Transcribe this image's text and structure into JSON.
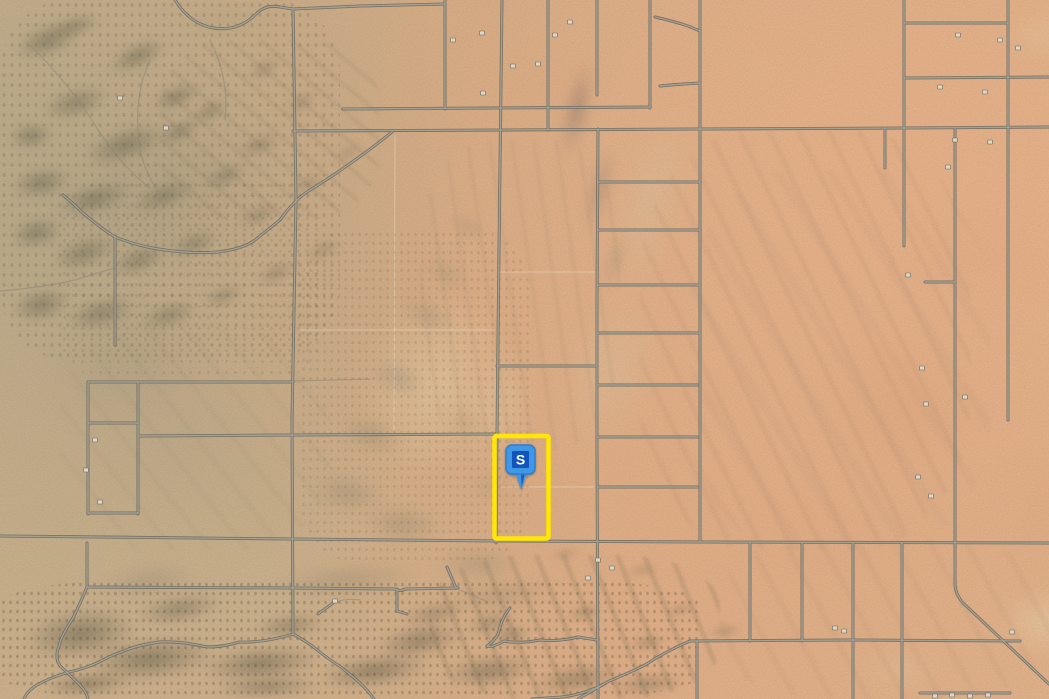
{
  "map": {
    "type": "satellite-parcel-map",
    "marker": {
      "label": "S",
      "x": 504,
      "y": 443,
      "width": 34,
      "height": 52,
      "head_fill": "#3f97e6",
      "head_stroke": "#2f7fd0",
      "inner_fill": "#1154bd",
      "tail_shade": "#1c5cb8",
      "label_color": "#ffffff"
    },
    "parcel_highlight": {
      "x": 494.5,
      "y": 436,
      "width": 54,
      "height": 102.5,
      "color": "#ffe604",
      "stroke_width": 4.5
    },
    "road_colors": {
      "casing": "#67655c",
      "fill": "#a6a396"
    },
    "roads": {
      "main": [
        "M175,0 Q190,24 213,28 Q238,32 256,14 Q266,4 280,7 L293,9 L360,6 L445,4",
        "M293,9 L296,200 L292,420 L293,634",
        "M502,0 L499,250 L497,434 L496,543",
        "M445,0 L445,109",
        "M548,0 L548,130",
        "M597,0 L597,95",
        "M598,129 L597,300 L597,450 L598,699",
        "M650,0 L650,108",
        "M700,0 L700,542",
        "M904,0 L904,246",
        "M955,129 L955,583 Q955,594 963,603 L1049,684",
        "M1008,0 L1008,420",
        "M885,129 L885,168",
        "M88,382 L88,514",
        "M138,382 L138,514",
        "M115,237 L115,345",
        "M293,131 L700,129 L905,128 L1049,127",
        "M343,109 L650,107",
        "M904,23 L1008,23",
        "M904,78 L1049,77",
        "M925,282 L955,282",
        "M598,182 L700,182",
        "M598,230 L700,230",
        "M598,285 L700,285",
        "M598,333 L700,333",
        "M597,385 L698,385",
        "M597,437 L698,437",
        "M597,487 L698,487",
        "M497,366 L597,366",
        "M88,382 L293,382",
        "M138,436 L293,435 L497,434",
        "M88,423 L138,423",
        "M88,513 L138,513",
        "M0,536 L293,539 L497,541 L700,542 L1049,543",
        "M88,587 L293,588 L395,589 Q401,592 405,589 L458,588",
        "M447,567 L456,588",
        "M318,614 L333,603",
        "M397,589 L397,611 L407,614",
        "M690,641 L853,640 L1020,641",
        "M690,641 Q668,650 645,665 Q622,676 607,682 Q596,689 583,696 L578,699",
        "M604,684 Q585,694 562,697 L532,699",
        "M597,640 L578,637 Q558,642 540,640 Q520,644 504,641 Q492,648 487,646 Q497,639 499,631 Q502,617 510,608",
        "M750,543 L750,641",
        "M802,543 L802,641",
        "M853,543 L853,699",
        "M902,543 L902,699",
        "M697,641 L697,699",
        "M87,543 L87,587 Q79,606 73,618 Q61,636 59,646 Q54,659 61,667 Q70,675 80,685 Q87,693 88,699",
        "M293,634 Q264,643 240,642 Q214,649 202,646 Q179,641 159,642 Q139,645 126,650 Q108,657 99,662 Q84,669 69,672 Q49,678 37,685 Q27,691 24,699",
        "M293,634 Q306,641 316,649 Q331,661 341,667 Q356,679 362,685 Q370,693 374,699",
        "M655,17 Q673,21 688,26 L700,31",
        "M660,86 Q680,84 700,83",
        "M920,693 L1010,693",
        "M63,195 Q75,205 83,213 Q98,226 115,237",
        "M115,237 Q140,247 165,250 Q195,254 218,252 Q243,249 255,240 Q270,228 280,220",
        "M392,132 Q375,146 355,160 Q330,178 310,190 Q295,199 280,220"
      ],
      "faint": [
        "M293,381 L370,379",
        "M0,291 Q45,287 75,280 Q100,272 115,268",
        "M30,45 Q70,85 95,125 Q120,165 150,188",
        "M150,60 Q132,100 140,150 Q146,175 160,195",
        "M210,40 Q230,80 225,120",
        "M455,588 Q475,596 488,602",
        "M333,603 Q345,598 360,600"
      ],
      "survey_lines": [
        "M395,135 L394,430",
        "M300,330 L495,330",
        "M500,272 L595,272",
        "M500,487 L595,487"
      ]
    },
    "buildings": [
      [
        482,
        33
      ],
      [
        555,
        35
      ],
      [
        570,
        22
      ],
      [
        513,
        66
      ],
      [
        538,
        64
      ],
      [
        483,
        93
      ],
      [
        453,
        40
      ],
      [
        958,
        35
      ],
      [
        1000,
        40
      ],
      [
        1018,
        48
      ],
      [
        940,
        87
      ],
      [
        985,
        92
      ],
      [
        955,
        140
      ],
      [
        990,
        142
      ],
      [
        948,
        167
      ],
      [
        908,
        275
      ],
      [
        922,
        368
      ],
      [
        965,
        397
      ],
      [
        926,
        404
      ],
      [
        918,
        477
      ],
      [
        931,
        496
      ],
      [
        835,
        628
      ],
      [
        844,
        631
      ],
      [
        1012,
        632
      ],
      [
        598,
        560
      ],
      [
        612,
        568
      ],
      [
        588,
        578
      ],
      [
        335,
        601
      ],
      [
        120,
        98
      ],
      [
        166,
        128
      ],
      [
        95,
        440
      ],
      [
        86,
        470
      ],
      [
        100,
        502
      ],
      [
        935,
        696
      ],
      [
        952,
        695
      ],
      [
        970,
        696
      ],
      [
        988,
        695
      ]
    ],
    "terrain": {
      "blobs": [
        [
          460,
          40,
          160,
          90,
          0,
          "#e2a87c",
          0.25,
          12
        ],
        [
          700,
          30,
          120,
          80,
          0,
          "#e8b88c",
          0.25,
          10
        ],
        [
          760,
          290,
          280,
          230,
          0,
          "#e0a074",
          0.3,
          14
        ],
        [
          860,
          170,
          240,
          170,
          0,
          "#e2a578",
          0.25,
          14
        ],
        [
          960,
          400,
          180,
          220,
          0,
          "#dfa077",
          0.22,
          14
        ],
        [
          720,
          470,
          220,
          130,
          0,
          "#e1a87f",
          0.22,
          12
        ],
        [
          975,
          575,
          150,
          95,
          0,
          "#ecd9b0",
          0.5,
          8
        ],
        [
          990,
          0,
          110,
          70,
          0,
          "#e8d2a8",
          0.35,
          8
        ],
        [
          840,
          640,
          120,
          60,
          0,
          "#e5cfa6",
          0.3,
          8
        ],
        [
          330,
          250,
          210,
          270,
          20,
          "#e8d4ab",
          0.5,
          10
        ],
        [
          455,
          330,
          90,
          160,
          15,
          "#e8d4ab",
          0.4,
          10
        ],
        [
          600,
          60,
          100,
          280,
          17,
          "#dcc49c",
          0.45,
          9
        ],
        [
          545,
          255,
          130,
          230,
          20,
          "#ddc8a2",
          0.4,
          10
        ],
        [
          0,
          60,
          340,
          260,
          -18,
          "#9a9078",
          0.3,
          14
        ],
        [
          0,
          260,
          260,
          200,
          -12,
          "#9a9078",
          0.28,
          14
        ],
        [
          40,
          330,
          280,
          230,
          -12,
          "#b3a584",
          0.35,
          12
        ],
        [
          150,
          420,
          220,
          160,
          -8,
          "#c0ad89",
          0.3,
          10
        ],
        [
          150,
          0,
          160,
          40,
          -5,
          "#b4a482",
          0.35,
          6
        ],
        [
          390,
          295,
          75,
          42,
          25,
          "#93886e",
          0.35,
          5
        ],
        [
          355,
          355,
          85,
          46,
          20,
          "#93886e",
          0.35,
          5
        ],
        [
          325,
          410,
          95,
          50,
          15,
          "#93886e",
          0.4,
          5
        ],
        [
          415,
          255,
          62,
          36,
          25,
          "#93886e",
          0.3,
          5
        ],
        [
          440,
          212,
          56,
          30,
          25,
          "#93886e",
          0.3,
          5
        ],
        [
          295,
          465,
          105,
          56,
          10,
          "#93886e",
          0.4,
          5
        ],
        [
          345,
          498,
          115,
          52,
          5,
          "#93886e",
          0.4,
          5
        ],
        [
          415,
          538,
          125,
          52,
          0,
          "#93886e",
          0.35,
          5
        ],
        [
          455,
          462,
          70,
          50,
          8,
          "#a08f6f",
          0.25,
          6
        ],
        [
          435,
          402,
          60,
          40,
          15,
          "#a08f6f",
          0.25,
          6
        ],
        [
          558,
          42,
          38,
          135,
          12,
          "#7e6a62",
          0.45,
          5
        ],
        [
          582,
          128,
          34,
          125,
          15,
          "#8d786c",
          0.38,
          5
        ],
        [
          600,
          215,
          30,
          90,
          17,
          "#97826f",
          0.3,
          5
        ],
        [
          0,
          18,
          95,
          45,
          -20,
          "#5e5b46",
          0.5,
          4
        ],
        [
          40,
          12,
          70,
          28,
          -15,
          "#5e5b46",
          0.45,
          4
        ],
        [
          95,
          38,
          85,
          36,
          -25,
          "#5e5b46",
          0.5,
          4
        ],
        [
          140,
          82,
          72,
          30,
          -20,
          "#5e5b46",
          0.5,
          4
        ],
        [
          28,
          82,
          95,
          42,
          -15,
          "#5e5b46",
          0.45,
          4
        ],
        [
          0,
          118,
          62,
          36,
          -5,
          "#5e5b46",
          0.5,
          4
        ],
        [
          68,
          122,
          115,
          46,
          -18,
          "#5e5b46",
          0.5,
          4
        ],
        [
          148,
          118,
          62,
          28,
          -25,
          "#5e5b46",
          0.45,
          4
        ],
        [
          182,
          98,
          56,
          26,
          -30,
          "#5e5b46",
          0.4,
          4
        ],
        [
          228,
          132,
          62,
          26,
          -20,
          "#5e5b46",
          0.4,
          4
        ],
        [
          0,
          162,
          82,
          42,
          -10,
          "#5e5b46",
          0.5,
          4
        ],
        [
          42,
          178,
          105,
          42,
          -15,
          "#5e5b46",
          0.5,
          4
        ],
        [
          118,
          178,
          92,
          36,
          -20,
          "#5e5b46",
          0.45,
          4
        ],
        [
          192,
          162,
          66,
          28,
          -25,
          "#5e5b46",
          0.4,
          4
        ],
        [
          238,
          58,
          52,
          22,
          -30,
          "#5e5b46",
          0.35,
          4
        ],
        [
          278,
          92,
          46,
          22,
          -30,
          "#5e5b46",
          0.35,
          4
        ],
        [
          0,
          212,
          72,
          42,
          -10,
          "#5e5b46",
          0.5,
          4
        ],
        [
          38,
          232,
          92,
          42,
          -18,
          "#5e5b46",
          0.45,
          4
        ],
        [
          98,
          242,
          82,
          36,
          -20,
          "#5e5b46",
          0.45,
          4
        ],
        [
          0,
          282,
          82,
          46,
          -12,
          "#5e5b46",
          0.5,
          4
        ],
        [
          52,
          292,
          98,
          42,
          -15,
          "#5e5b46",
          0.45,
          4
        ],
        [
          128,
          298,
          82,
          34,
          -18,
          "#5e5b46",
          0.4,
          4
        ],
        [
          192,
          282,
          62,
          28,
          -22,
          "#5e5b46",
          0.35,
          4
        ],
        [
          248,
          260,
          56,
          26,
          -25,
          "#5e5b46",
          0.35,
          4
        ],
        [
          298,
          238,
          52,
          24,
          -28,
          "#5e5b46",
          0.3,
          4
        ],
        [
          158,
          228,
          72,
          32,
          -20,
          "#5e5b46",
          0.4,
          4
        ],
        [
          228,
          202,
          62,
          26,
          -24,
          "#5e5b46",
          0.35,
          4
        ],
        [
          282,
          172,
          52,
          24,
          -28,
          "#5e5b46",
          0.3,
          4
        ],
        [
          325,
          142,
          46,
          22,
          -30,
          "#5e5b46",
          0.25,
          4
        ],
        [
          0,
          598,
          160,
          72,
          -8,
          "#575440",
          0.5,
          4
        ],
        [
          58,
          628,
          185,
          62,
          -6,
          "#575440",
          0.5,
          4
        ],
        [
          178,
          638,
          165,
          52,
          -5,
          "#575440",
          0.5,
          4
        ],
        [
          298,
          648,
          152,
          46,
          -8,
          "#575440",
          0.5,
          4
        ],
        [
          118,
          588,
          122,
          42,
          -10,
          "#575440",
          0.4,
          4
        ],
        [
          238,
          608,
          102,
          36,
          -8,
          "#575440",
          0.4,
          4
        ],
        [
          358,
          618,
          122,
          46,
          -10,
          "#575440",
          0.45,
          4
        ],
        [
          428,
          648,
          122,
          46,
          -6,
          "#575440",
          0.45,
          4
        ],
        [
          515,
          658,
          122,
          42,
          -8,
          "#575440",
          0.4,
          4
        ],
        [
          388,
          598,
          92,
          32,
          -12,
          "#575440",
          0.35,
          4
        ],
        [
          595,
          668,
          105,
          32,
          -5,
          "#575440",
          0.35,
          4
        ],
        [
          25,
          668,
          125,
          32,
          -4,
          "#575440",
          0.5,
          4
        ],
        [
          195,
          672,
          145,
          30,
          -3,
          "#575440",
          0.45,
          4
        ],
        [
          455,
          608,
          72,
          30,
          -15,
          "#575440",
          0.35,
          4
        ],
        [
          240,
          558,
          210,
          44,
          -5,
          "#7a745c",
          0.3,
          6
        ],
        [
          420,
          575,
          160,
          40,
          -8,
          "#7a745c",
          0.28,
          6
        ],
        [
          80,
          560,
          140,
          40,
          -6,
          "#7a745c",
          0.28,
          6
        ],
        [
          480,
          620,
          60,
          30,
          -10,
          "#5a573f",
          0.35,
          3
        ],
        [
          560,
          600,
          50,
          25,
          -10,
          "#5a573f",
          0.3,
          3
        ],
        [
          620,
          630,
          55,
          25,
          -8,
          "#5a573f",
          0.3,
          3
        ],
        [
          660,
          600,
          40,
          20,
          -10,
          "#5a573f",
          0.25,
          3
        ],
        [
          700,
          620,
          50,
          22,
          -8,
          "#5a573f",
          0.25,
          3
        ],
        [
          620,
          560,
          45,
          20,
          -10,
          "#5a573f",
          0.22,
          3
        ],
        [
          545,
          545,
          40,
          18,
          -8,
          "#5a573f",
          0.22,
          3
        ]
      ],
      "streaks": [
        [
          640,
          130,
          330,
          420,
          64,
          "rgba(185,145,115,0.16)",
          5,
          22
        ],
        [
          690,
          170,
          300,
          380,
          58,
          "rgba(200,160,128,0.14)",
          9,
          36
        ],
        [
          420,
          140,
          200,
          310,
          82,
          "rgba(175,145,115,0.14)",
          4,
          18
        ],
        [
          430,
          555,
          290,
          144,
          68,
          "rgba(110,100,76,0.18)",
          5,
          20
        ],
        [
          60,
          330,
          270,
          220,
          52,
          "rgba(165,150,120,0.14)",
          5,
          24
        ],
        [
          160,
          40,
          220,
          180,
          40,
          "rgba(120,112,88,0.12)",
          4,
          16
        ],
        [
          720,
          540,
          329,
          159,
          62,
          "rgba(190,150,118,0.14)",
          6,
          26
        ]
      ],
      "speckles": [
        [
          0,
          580,
          700,
          119,
          "rgba(60,58,40,0.5)",
          1.1,
          7,
          9,
          0.5
        ],
        [
          0,
          0,
          340,
          360,
          "rgba(70,68,50,0.45)",
          1.2,
          8,
          10,
          0.45
        ],
        [
          300,
          230,
          230,
          330,
          "rgba(90,82,58,0.4)",
          1,
          7,
          9,
          0.4
        ],
        [
          60,
          180,
          260,
          200,
          "rgba(80,76,56,0.4)",
          1,
          9,
          11,
          0.35
        ]
      ]
    }
  }
}
